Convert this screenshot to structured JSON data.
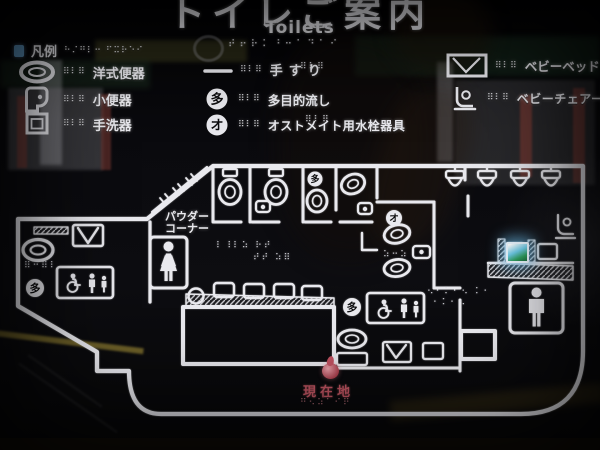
{
  "colors": {
    "engraving": "#e9e9ee",
    "current_red": "#c25663",
    "marker_red": "#b2434f",
    "glow_blue": "#8fd2f0",
    "legend_blue": "#6fb2e4"
  },
  "title": {
    "ja": "トイレご案内",
    "en": "Toilets"
  },
  "legend": {
    "header": "凡例",
    "left": [
      {
        "icon": "western-toilet-icon",
        "label": "洋式便器"
      },
      {
        "icon": "urinal-icon",
        "label": "小便器"
      },
      {
        "icon": "hand-basin-icon",
        "label": "手洗器"
      }
    ],
    "mid": [
      {
        "icon": "handrail-icon",
        "label": "手すり"
      },
      {
        "icon": "circle-ta-icon",
        "glyph": "多",
        "label": "多目的流し"
      },
      {
        "icon": "circle-o-icon",
        "glyph": "オ",
        "label": "オストメイト用水栓器具"
      }
    ],
    "right": [
      {
        "icon": "baby-bed-icon",
        "label": "ベビーベッド"
      },
      {
        "icon": "baby-chair-icon",
        "label": "ベビーチェアー"
      }
    ]
  },
  "map": {
    "powder_line1": "パウダー",
    "powder_line2": "コーナー",
    "current_location": "現在地",
    "glyph_ta": "多",
    "glyph_o": "オ"
  },
  "braille": {
    "title": "⠞⠖⠗⠅⠘⠒⠁⠙⠁⠊",
    "header": "⠓⠌⠛⠇⠒ ⠋⠭⠗⠑⠊",
    "row": "⠿⠇⠿",
    "women_a": "⠇⠸⠇⠵ ⠗⠞",
    "women_b": "⠞⠞ ⠵⠿",
    "left_room": "⠿⠒⠿⠇",
    "mid_room": "⠵⠒⠵",
    "mens_a": "⠢⠂⠅⠂⠢ ⠅⠂",
    "mens_b": "⠂⠅⠂⠢",
    "current": "⠛⠢⠵⠁⠊⠟"
  }
}
